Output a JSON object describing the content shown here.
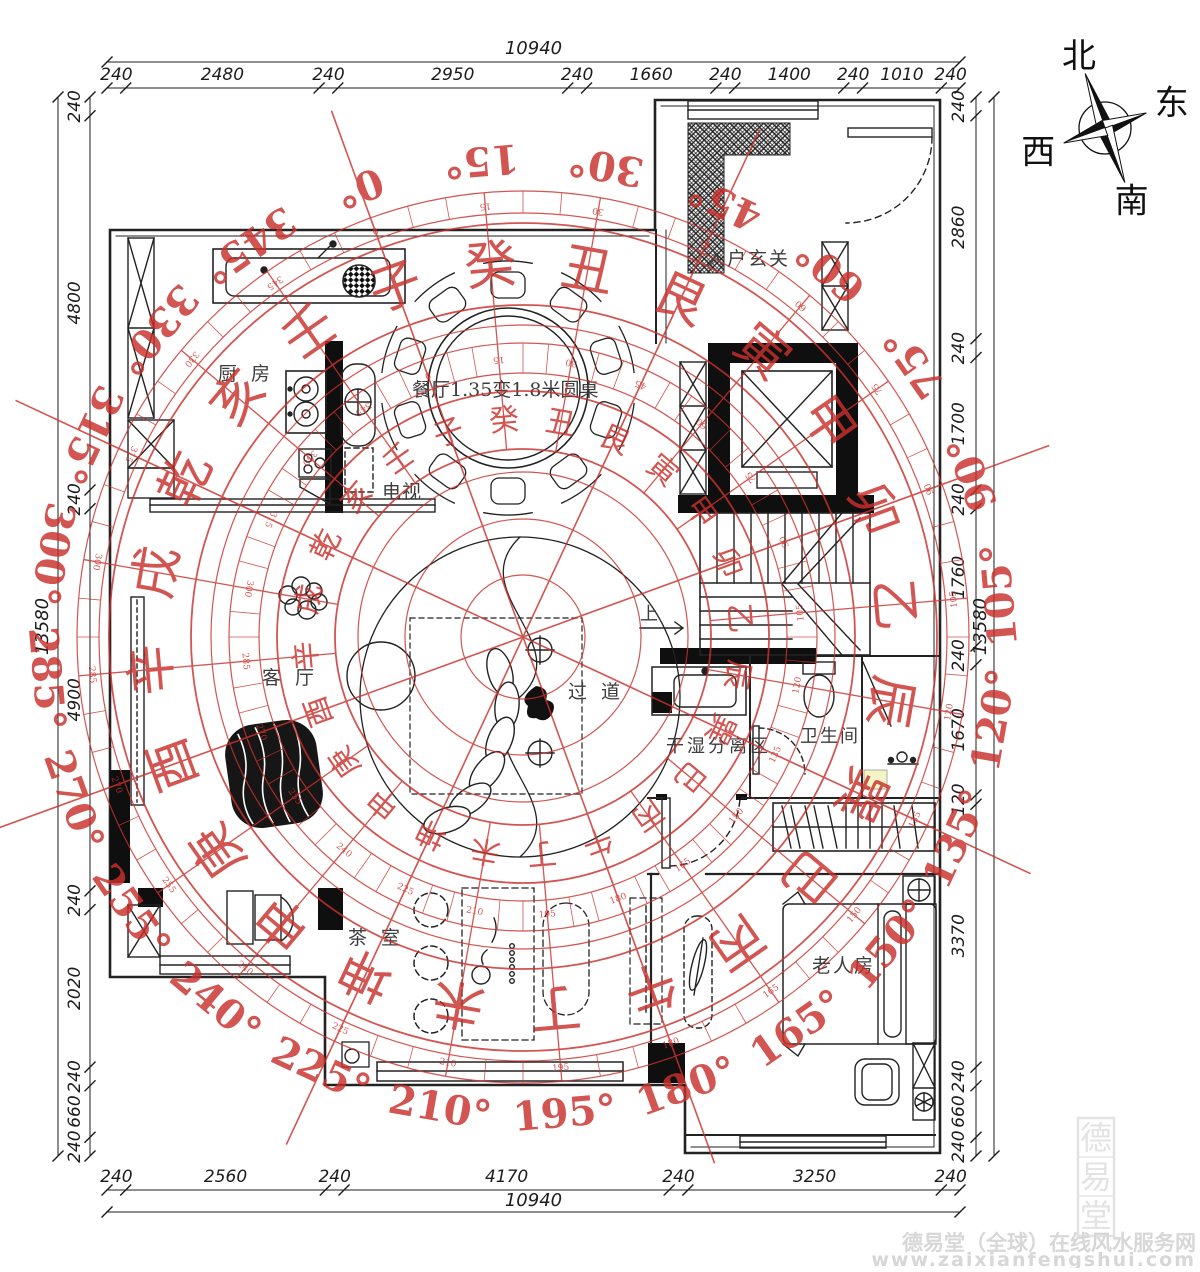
{
  "rooms": {
    "kitchen": "厨 房",
    "entry": "入户玄关",
    "tv": "电视",
    "dining_table": "餐厅1.35变1.8米圆桌",
    "living": "客 厅",
    "corridor": "过 道",
    "dry_wet": "干湿分离区",
    "bathroom": "卫生间",
    "tea": "茶 室",
    "elder": "老人房",
    "stairs_up": "上"
  },
  "compass": {
    "center_x": 523,
    "center_y": 637,
    "rotation_deg": -20,
    "color": "#c9302c",
    "degree_step": 15,
    "mountains": [
      "子",
      "癸",
      "丑",
      "艮",
      "寅",
      "甲",
      "卯",
      "乙",
      "辰",
      "巽",
      "巳",
      "丙",
      "午",
      "丁",
      "未",
      "坤",
      "申",
      "庚",
      "酉",
      "辛",
      "戌",
      "乾",
      "亥",
      "壬"
    ]
  },
  "rose": {
    "n": "北",
    "e": "东",
    "s": "南",
    "w": "西"
  },
  "dims": {
    "top": {
      "total": "10940",
      "segments": [
        240,
        2480,
        240,
        2950,
        240,
        1660,
        240,
        1400,
        240,
        1010,
        240
      ]
    },
    "bottom": {
      "total": "10940",
      "segments": [
        240,
        2560,
        240,
        4170,
        240,
        3250,
        240
      ]
    },
    "left": {
      "total": "13580",
      "segments": [
        240,
        4800,
        240,
        4900,
        240,
        2020,
        240,
        660,
        240
      ]
    },
    "right": {
      "total": "13580",
      "segments": [
        240,
        2860,
        240,
        1700,
        240,
        1760,
        240,
        1670,
        120,
        3370,
        240,
        660,
        240
      ]
    }
  },
  "watermark": {
    "seal_chars": [
      "德",
      "易",
      "堂"
    ],
    "line1": "德易堂（全球）在线风水服务网",
    "line2": "www.zaixianfengshui.com"
  }
}
